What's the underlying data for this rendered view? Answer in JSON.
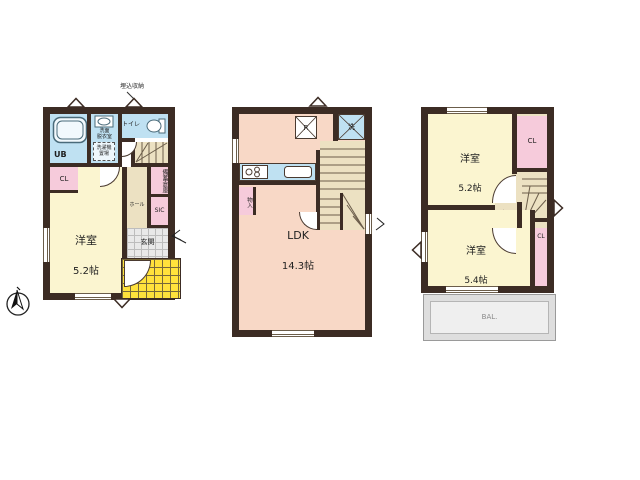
{
  "colors": {
    "wall": "#3c2c24",
    "wet_blue": "#bfe1f2",
    "room_cream": "#fbf5d0",
    "ldk_salmon": "#f8d8c6",
    "closet_pink": "#f6cbdb",
    "stair_beige": "#ece1c2",
    "porch_yellow": "#ffe23c",
    "balcony_gray": "#e9e9e9"
  },
  "floor1": {
    "ub": "UB",
    "washroom": "洗面\n脱衣室",
    "washer_box": "洗濯機\n置場",
    "toilet": "トイレ",
    "storage_note": "埋込収納",
    "cl": "CL",
    "room_name": "洋室",
    "room_size": "5.2帖",
    "hall": "ホール",
    "stock": "備蓄倉庫",
    "sic": "SIC",
    "entrance": "玄関"
  },
  "floor2": {
    "ldk": "LDK",
    "ldk_size": "14.3帖",
    "fridge": "R",
    "laundry": "洗",
    "storage": "物入"
  },
  "floor3": {
    "room_top_name": "洋室",
    "room_top_size": "5.2帖",
    "cl_top": "CL",
    "hall": "ホール",
    "room_bottom_name": "洋室",
    "room_bottom_size": "5.4帖",
    "cl_bottom": "CL",
    "balcony": "BAL."
  }
}
